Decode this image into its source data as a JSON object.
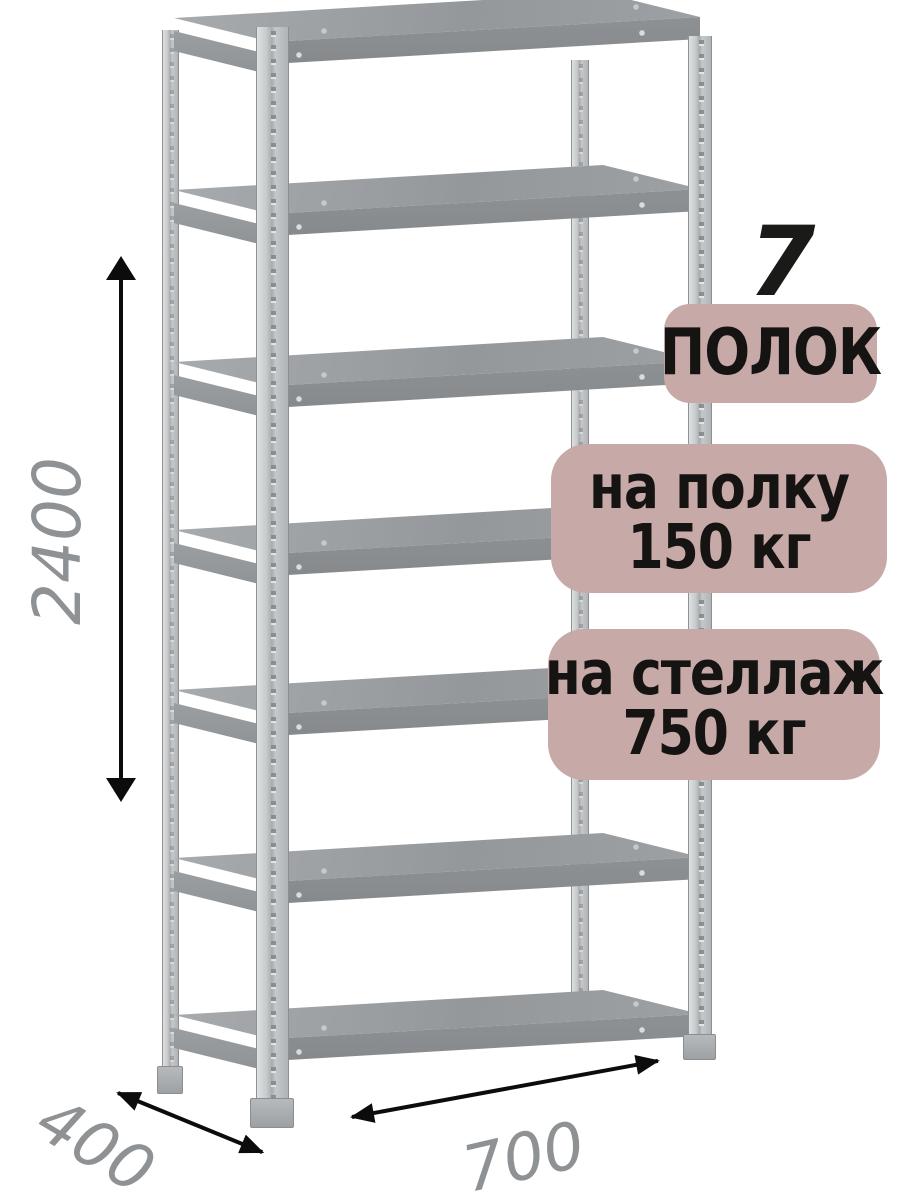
{
  "badges": {
    "count": "7",
    "count_label": "ПОЛОК",
    "per_shelf": {
      "line1": "на полку",
      "line2": "150 кг"
    },
    "per_rack": {
      "line1": "на стеллаж",
      "line2": "750 кг"
    }
  },
  "dimensions": {
    "height_mm": "2400",
    "depth_mm": "400",
    "width_mm": "700"
  },
  "structure": {
    "shelf_count": 7
  },
  "colors": {
    "background": "#ffffff",
    "badge_bg": "#c7a9a8",
    "badge_text": "#161412",
    "dimension_text": "#8f9294",
    "arrow": "#0c0c0c",
    "metal_light": "#dee0e1",
    "metal_mid": "#c2c5c7",
    "shelf_top": "#9a9ea1",
    "shelf_front": "#84888b"
  }
}
